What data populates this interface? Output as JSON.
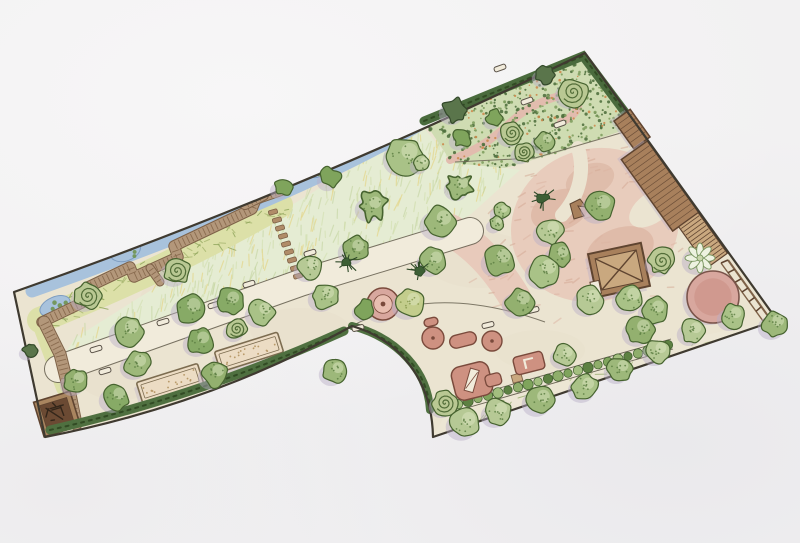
{
  "meta": {
    "title": "Hand-drawn garden landscape design plan (scanned watercolor site plan)",
    "canvas": {
      "w": 800,
      "h": 543
    }
  },
  "scene": {
    "palette": {
      "paper": "#f2f1f2",
      "ground": "#ebe4d1",
      "blotch": "#e2d9c2",
      "boundary": "#3f3a30",
      "shadow": "#b9aec6",
      "lawn": "#e5ecd3",
      "lawn_strokes": [
        "#c6d6a4",
        "#d3e0b2",
        "#e4d584",
        "#cfdcaa"
      ],
      "marsh": "#dce0a8",
      "marsh_scribble": [
        "#93a860",
        "#aab873"
      ],
      "water": "#a8c2dc",
      "water_edge": "#7d9cc0",
      "water_plant": "#6f9450",
      "walk_fill": "#b3977a",
      "walk_edge": "#7e6248",
      "walk_tick": "#86684c",
      "path_fill": "#f1ebdb",
      "path_edge": "#6a6454",
      "stone": "#b08c68",
      "bed_fill": "#ecdcc4",
      "bed_edge": "#7c6c50",
      "bed_dot": "#b89a6a",
      "hedge": "#4f7040",
      "hedge_dark": "#324b24",
      "hedge_top": "#4a6b3d",
      "orn_base": "#cfdcb2",
      "orn_dots": [
        "#51713f",
        "#7f9f5f",
        "#cc8a4e"
      ],
      "pink_ground": "#e8cabb",
      "pink_deep": "#dcb6a4",
      "pink_path": "#e2bcae",
      "pink_texture": [
        "#dcb4a2",
        "#d3a893"
      ],
      "play_fill": "#ce9181",
      "play_light": "#e8beb0",
      "play_edge": "#7a4a3c",
      "pink_circle": "#d8a79e",
      "pink_circle_core": "#cf978c",
      "pink_circle_edge": "#7a544a",
      "wood": "#a8805c",
      "wood_light": "#c9a87f",
      "wood_edge": "#5f4430",
      "square_outer": "#a9855f",
      "square_inner": "#6b4a33",
      "square_scribble": "#33261a",
      "bench_fill": "#f1ebdb",
      "bench_edge": "#5a5248",
      "strip_fill": "#ece6d4",
      "strip_scribble": [
        "#9db075",
        "#b9c490"
      ],
      "hedgerow_band": "#e9e3d1",
      "hedgerow_greens": [
        "#7fa45c",
        "#a3bf7f",
        "#5d8142",
        "#8fae6b"
      ],
      "hedgerow_edge": "#3f5c2e",
      "tree_greens": [
        "#a9c287",
        "#93b06f",
        "#b6c995",
        "#87aa66",
        "#9db87a"
      ],
      "tree_outline": "#46632f",
      "tree_dot": "#5d7f43",
      "tree_highlight": "#dfe9c6"
    },
    "boundary": {
      "d": "M 14 292 Q 300 192 585 53 L 777 320 L 433 437 C 432 380 400 340 352 326 Q 210 405 45 437 Z",
      "width": 2.2
    },
    "blotches": [
      {
        "cx": 200,
        "cy": 300,
        "rx": 60,
        "ry": 30,
        "o": 0.25
      },
      {
        "cx": 480,
        "cy": 260,
        "rx": 55,
        "ry": 28,
        "o": 0.2
      },
      {
        "cx": 620,
        "cy": 200,
        "rx": 40,
        "ry": 25,
        "o": 0.2
      },
      {
        "cx": 300,
        "cy": 330,
        "rx": 50,
        "ry": 22,
        "o": 0.2
      },
      {
        "cx": 540,
        "cy": 350,
        "rx": 45,
        "ry": 20,
        "o": 0.22
      },
      {
        "cx": 120,
        "cy": 380,
        "rx": 40,
        "ry": 20,
        "o": 0.2
      }
    ],
    "lawn": {
      "poly": [
        [
          300,
          200
        ],
        [
          422,
          126
        ],
        [
          452,
          161
        ],
        [
          520,
          170
        ],
        [
          470,
          215
        ],
        [
          440,
          231
        ],
        [
          300,
          276
        ],
        [
          150,
          324
        ],
        [
          62,
          358
        ],
        [
          75,
          338
        ],
        [
          140,
          297
        ]
      ],
      "strokes": {
        "count": 320,
        "angle": -78,
        "jitter": 16,
        "lenMin": 6,
        "lenMax": 14,
        "width": 1.2,
        "opacity": 0.65
      }
    },
    "marsh": {
      "band": {
        "d": "M 40 320 Q 170 268 280 205",
        "width": 26
      },
      "leg": {
        "d": "M 38 318 L 64 388",
        "width": 16
      },
      "scribbles": {
        "count": 70,
        "p0": [
          40,
          320
        ],
        "c": [
          170,
          268
        ],
        "p1": [
          280,
          205
        ],
        "spread": 11,
        "lenMin": 4,
        "lenMax": 9,
        "width": 1,
        "opacity": 0.85
      }
    },
    "water": {
      "stream": {
        "d": "M 32 291 Q 300 196 422 123",
        "width": 13
      },
      "edge": {
        "d": "M 30 288 Q 298 192 420 120",
        "width": 2.2
      },
      "ponds": [
        {
          "cx": 55,
          "cy": 306,
          "rx": 16,
          "ry": 9,
          "rot": -24
        },
        {
          "cx": 125,
          "cy": 250,
          "rx": 16,
          "ry": 11,
          "rot": -20
        },
        {
          "cx": 254,
          "cy": 198,
          "rx": 13,
          "ry": 8,
          "rot": -20
        },
        {
          "cx": 318,
          "cy": 171,
          "rx": 10,
          "ry": 6,
          "rot": -20
        }
      ]
    },
    "ornamental": {
      "poly": [
        [
          424,
          121
        ],
        [
          583,
          55
        ],
        [
          636,
          126
        ],
        [
          560,
          152
        ],
        [
          505,
          168
        ],
        [
          452,
          163
        ]
      ],
      "stipple": [
        {
          "color_i": 0,
          "count": 240,
          "rMin": 0.8,
          "rMax": 1.8
        },
        {
          "color_i": 1,
          "count": 150,
          "rMin": 0.8,
          "rMax": 1.6
        },
        {
          "color_i": 2,
          "count": 70,
          "rMin": 0.7,
          "rMax": 1.4
        }
      ],
      "pink_path": {
        "d": "M 450 160 C 478 150 494 138 512 121 C 528 106 552 96 574 93 C 584 104 576 116 561 122",
        "width": 8
      }
    },
    "pink_zone": {
      "blobs": [
        {
          "cx": 595,
          "cy": 225,
          "rx": 85,
          "ry": 76,
          "rot": -20,
          "o": 0.95
        },
        {
          "cx": 560,
          "cy": 210,
          "rx": 30,
          "ry": 20,
          "rot": -20,
          "deep": true,
          "o": 0.8
        },
        {
          "cx": 620,
          "cy": 250,
          "rx": 35,
          "ry": 22,
          "rot": -20,
          "deep": true,
          "o": 0.8
        },
        {
          "cx": 590,
          "cy": 180,
          "rx": 25,
          "ry": 16,
          "rot": -20,
          "deep": true,
          "o": 0.7
        }
      ],
      "bands": [
        {
          "d": "M 450 230 C 475 245 495 265 515 298",
          "width": 32
        }
      ],
      "cutouts": [
        {
          "type": "band",
          "d": "M 578 148 C 585 170 580 195 562 215",
          "width": 14
        },
        {
          "type": "ellipse",
          "cx": 652,
          "cy": 208,
          "rx": 15,
          "ry": 26,
          "rot": 54
        }
      ],
      "texture": {
        "poly": [
          [
            520,
            172
          ],
          [
            636,
            130
          ],
          [
            700,
            215
          ],
          [
            662,
            300
          ],
          [
            560,
            330
          ],
          [
            472,
            302
          ],
          [
            450,
            252
          ]
        ],
        "count": 80,
        "angle": -25,
        "jitter": 25,
        "lenMin": 4,
        "lenMax": 10,
        "width": 1.5,
        "opacity": 0.5
      }
    },
    "strip_se": {
      "poly": [
        [
          433,
          437
        ],
        [
          450,
          406
        ],
        [
          672,
          342
        ],
        [
          777,
          320
        ]
      ],
      "grass": {
        "count": 48,
        "p0": [
          452,
          422
        ],
        "p1": [
          750,
          332
        ],
        "spread": 8,
        "lenMin": 5,
        "lenMax": 12,
        "width": 1,
        "opacity": 0.85
      }
    },
    "main_path": {
      "d": "M 58 369 L 300 283 L 470 231",
      "width": 26
    },
    "boardwalk": {
      "main": {
        "d": "M 42 322 L 90 299 L 86 288 L 130 267 L 134 277 L 178 257 L 174 246 L 252 209 L 256 199 L 282 190",
        "width": 9.5,
        "pts": [
          [
            42,
            322
          ],
          [
            90,
            299
          ],
          [
            86,
            288
          ],
          [
            130,
            267
          ],
          [
            134,
            277
          ],
          [
            178,
            257
          ],
          [
            174,
            246
          ],
          [
            252,
            209
          ],
          [
            256,
            199
          ],
          [
            282,
            190
          ]
        ]
      },
      "leg": {
        "d": "M 44 322 L 60 354 L 70 394 L 76 424",
        "width": 11,
        "pts": [
          [
            44,
            322
          ],
          [
            60,
            354
          ],
          [
            70,
            394
          ],
          [
            76,
            424
          ]
        ]
      },
      "spur": {
        "d": "M 150 268 L 160 282",
        "width": 7,
        "pts": [
          [
            150,
            268
          ],
          [
            160,
            282
          ]
        ]
      },
      "bridge": {
        "d": "M 245 204 L 263 195",
        "width": 10,
        "pts": [
          [
            245,
            204
          ],
          [
            263,
            195
          ]
        ]
      }
    },
    "stepping_stones": {
      "w": 9,
      "h": 4.5,
      "rot": -15,
      "stones": [
        [
          273,
          212
        ],
        [
          277,
          220
        ],
        [
          280,
          228
        ],
        [
          283,
          236
        ],
        [
          286,
          244
        ],
        [
          289,
          252
        ],
        [
          292,
          260
        ],
        [
          295,
          268
        ],
        [
          298,
          276
        ]
      ]
    },
    "beds": [
      {
        "cx": 170,
        "cy": 383,
        "w": 64,
        "h": 21,
        "rot": -17.5
      },
      {
        "cx": 249,
        "cy": 352,
        "w": 66,
        "h": 21,
        "rot": -17.5
      }
    ],
    "dark_square": {
      "cx": 57,
      "cy": 414,
      "w": 38,
      "h": 36,
      "rot": -17
    },
    "benches": [
      [
        96,
        349,
        -17
      ],
      [
        105,
        371,
        -17
      ],
      [
        163,
        322,
        -17
      ],
      [
        214,
        305,
        -17
      ],
      [
        249,
        284,
        -17
      ],
      [
        310,
        253,
        -17
      ],
      [
        488,
        325,
        -14
      ],
      [
        533,
        310,
        -14
      ],
      [
        358,
        328,
        -14
      ],
      [
        500,
        68,
        -20
      ],
      [
        527,
        101,
        -20
      ],
      [
        560,
        124,
        -20
      ]
    ],
    "division_lines": [
      {
        "d": "M 638 128 L 535 158 L 455 162",
        "w": 1,
        "o": 0.85
      },
      {
        "d": "M 352 326 C 400 300 460 292 545 322",
        "w": 1,
        "o": 0.85
      }
    ],
    "hedges": {
      "bottom": {
        "d": "M 50 430 Q 200 396 344 331",
        "width": 9
      },
      "notch": {
        "d": "M 352 326 C 398 338 428 372 430 410",
        "width": 8
      },
      "top": {
        "d": "M 424 121 L 583 56 L 633 123",
        "width": 9
      },
      "hedgerow": {
        "band": {
          "d": "M 448 408 L 672 344",
          "width": 11
        },
        "edgeA": {
          "d": "M 449 413 L 673 349"
        },
        "edgeB": {
          "d": "M 447 403 L 671 339"
        },
        "n": 23,
        "x0": 448,
        "y0": 407,
        "x1": 668,
        "y1": 345,
        "gap": {
          "cx": 517,
          "cy": 378,
          "w": 10,
          "h": 8,
          "rot": -16
        }
      }
    },
    "buildings": {
      "edge_angle": 54.3,
      "shed_small": {
        "cx": 632,
        "cy": 129,
        "w": 34,
        "h": 20
      },
      "shed_main": {
        "cx": 660,
        "cy": 186,
        "w": 88,
        "h": 32
      },
      "stairs": {
        "cx": 703,
        "cy": 240,
        "w": 50,
        "h": 24
      },
      "fence": {
        "a": [
          [
            728,
            260
          ],
          [
            768,
            316
          ]
        ],
        "b": [
          [
            721,
            263
          ],
          [
            763,
            321
          ]
        ],
        "posts": 7
      },
      "playhouse": {
        "cx": 619,
        "cy": 270,
        "w": 54,
        "h": 44,
        "rot": -12,
        "door": {
          "x": 588,
          "y": 276,
          "w": 9,
          "h": 13
        }
      },
      "tent": {
        "points": [
          [
            570,
            204
          ],
          [
            580,
            199
          ],
          [
            586,
            207
          ],
          [
            578,
            206
          ],
          [
            584,
            216
          ],
          [
            574,
            219
          ]
        ]
      }
    },
    "play_items": [
      {
        "type": "ring",
        "cx": 383,
        "cy": 304,
        "r": 16
      },
      {
        "type": "disc",
        "cx": 433,
        "cy": 338,
        "r": 11
      },
      {
        "type": "capsule",
        "cx": 463,
        "cy": 340,
        "w": 27,
        "h": 13,
        "rot": -14
      },
      {
        "type": "disc",
        "cx": 492,
        "cy": 341,
        "r": 10
      },
      {
        "type": "capsule",
        "cx": 431,
        "cy": 322,
        "w": 14,
        "h": 8,
        "rot": -14
      },
      {
        "type": "slide",
        "cx": 472,
        "cy": 381,
        "w": 38,
        "h": 34,
        "rot": -14
      },
      {
        "type": "table",
        "cx": 529,
        "cy": 363,
        "w": 30,
        "h": 18,
        "rot": -14
      },
      {
        "type": "dot",
        "cx": 520,
        "cy": 305,
        "r": 5
      }
    ],
    "trees": [
      [
        88,
        296,
        13,
        "sp"
      ],
      [
        177,
        271,
        13,
        "sp"
      ],
      [
        237,
        329,
        10,
        "sp"
      ],
      [
        128,
        331,
        15,
        "r"
      ],
      [
        137,
        364,
        13,
        "r"
      ],
      [
        76,
        381,
        12,
        "r"
      ],
      [
        116,
        397,
        13,
        "r"
      ],
      [
        190,
        309,
        15,
        "r"
      ],
      [
        200,
        341,
        13,
        "r"
      ],
      [
        230,
        301,
        13,
        "r"
      ],
      [
        262,
        312,
        13,
        "r"
      ],
      [
        215,
        374,
        13,
        "r"
      ],
      [
        30,
        350,
        7,
        "shd"
      ],
      [
        405,
        156,
        18,
        "r"
      ],
      [
        372,
        206,
        13,
        "sc"
      ],
      [
        422,
        163,
        8,
        "r"
      ],
      [
        460,
        186,
        12,
        "sc"
      ],
      [
        283,
        187,
        9,
        "sh"
      ],
      [
        331,
        178,
        10,
        "sh"
      ],
      [
        355,
        249,
        13,
        "r"
      ],
      [
        433,
        261,
        13,
        "r"
      ],
      [
        310,
        267,
        12,
        "r"
      ],
      [
        325,
        296,
        13,
        "r"
      ],
      [
        440,
        222,
        16,
        "r"
      ],
      [
        347,
        262,
        9,
        "sk"
      ],
      [
        419,
        271,
        9,
        "sk"
      ],
      [
        543,
        198,
        10,
        "sk"
      ],
      [
        545,
        141,
        10,
        "r"
      ],
      [
        502,
        211,
        8,
        "r"
      ],
      [
        497,
        223,
        7,
        "r"
      ],
      [
        550,
        231,
        13,
        "r"
      ],
      [
        600,
        206,
        15,
        "r"
      ],
      [
        560,
        255,
        12,
        "r"
      ],
      [
        500,
        260,
        15,
        "r"
      ],
      [
        545,
        271,
        16,
        "r"
      ],
      [
        520,
        302,
        14,
        "r"
      ],
      [
        590,
        300,
        14,
        "r"
      ],
      [
        630,
        298,
        14,
        "r"
      ],
      [
        662,
        261,
        13,
        "sp"
      ],
      [
        640,
        330,
        14,
        "r"
      ],
      [
        700,
        258,
        14,
        "pal"
      ],
      [
        655,
        310,
        13,
        "r"
      ],
      [
        775,
        324,
        13,
        "r"
      ],
      [
        733,
        316,
        12,
        "r"
      ],
      [
        693,
        331,
        12,
        "r"
      ],
      [
        713,
        297,
        26,
        "pc"
      ],
      [
        445,
        403,
        12,
        "sp"
      ],
      [
        465,
        423,
        15,
        "r"
      ],
      [
        498,
        412,
        13,
        "r"
      ],
      [
        540,
        400,
        14,
        "r"
      ],
      [
        585,
        387,
        13,
        "r"
      ],
      [
        620,
        369,
        12,
        "r"
      ],
      [
        658,
        351,
        12,
        "r"
      ],
      [
        565,
        355,
        11,
        "r"
      ],
      [
        335,
        371,
        12,
        "r"
      ],
      [
        365,
        309,
        9,
        "sh"
      ],
      [
        410,
        303,
        14,
        "ry"
      ],
      [
        573,
        92,
        14,
        "sp"
      ],
      [
        512,
        133,
        11,
        "sp"
      ],
      [
        524,
        152,
        9,
        "sp"
      ],
      [
        455,
        110,
        12,
        "shd"
      ],
      [
        462,
        138,
        9,
        "sh"
      ],
      [
        495,
        118,
        8,
        "sh"
      ],
      [
        545,
        75,
        9,
        "shd"
      ]
    ]
  }
}
